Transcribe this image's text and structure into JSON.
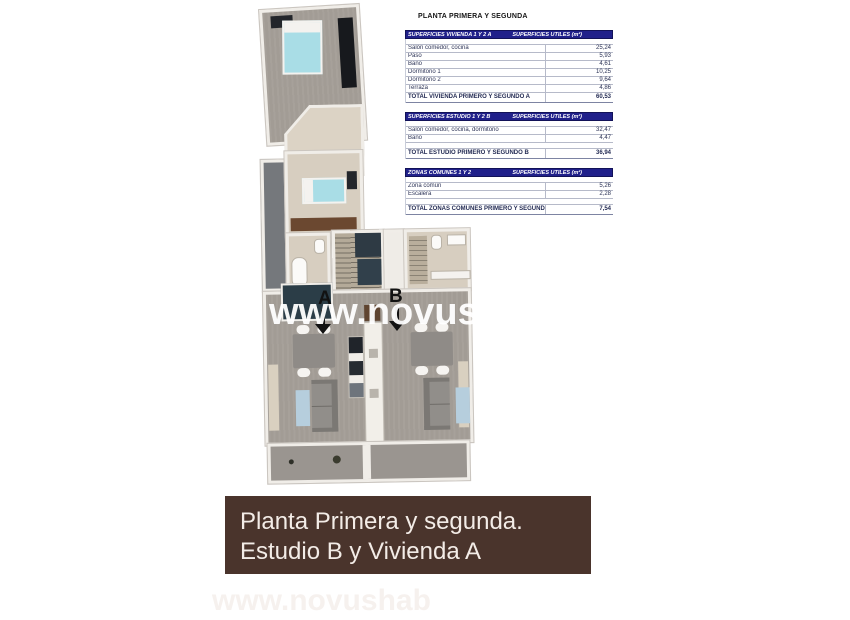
{
  "plan_title": "PLANTA PRIMERA Y SEGUNDA",
  "area_tables": [
    {
      "header_left": "SUPERFICIES VIVIENDA 1 Y 2 A",
      "header_right": "SUPERFICIES UTILES  (m²)",
      "rows": [
        {
          "label": "Salón comedor, cocina",
          "value": "25,24"
        },
        {
          "label": "Paso",
          "value": "5,93"
        },
        {
          "label": "Baño",
          "value": "4,61"
        },
        {
          "label": "Dormitorio 1",
          "value": "10,25"
        },
        {
          "label": "Dormitorio 2",
          "value": "9,64"
        },
        {
          "label": "Terraza",
          "value": "4,86"
        }
      ],
      "total_label": "TOTAL VIVIENDA PRIMERO Y SEGUNDO A",
      "total_value": "60,53"
    },
    {
      "header_left": "SUPERFICIES ESTUDIO 1 Y 2 B",
      "header_right": "SUPERFICIES UTILES  (m²)",
      "rows": [
        {
          "label": "Salón comedor, cocina, dormitorio",
          "value": "32,47"
        },
        {
          "label": "Baño",
          "value": "4,47"
        }
      ],
      "total_label": "TOTAL ESTUDIO PRIMERO Y SEGUNDO B",
      "total_value": "36,94"
    },
    {
      "header_left": "ZONAS COMUNES 1 Y 2",
      "header_right": "SUPERFICIES UTILES  (m²)",
      "rows": [
        {
          "label": "Zona común",
          "value": "5,26"
        },
        {
          "label": "Escalera",
          "value": "2,28"
        }
      ],
      "total_label": "TOTAL ZONAS COMUNES PRIMERO Y SEGUNDO",
      "total_value": "7,54"
    }
  ],
  "floor_plan": {
    "unit_a": "A",
    "unit_b": "B",
    "watermark": "www.novushab"
  },
  "caption": {
    "line1": "Planta Primera y segunda.",
    "line2": "Estudio B y Vivienda A"
  },
  "colors": {
    "table_header_bg": "#20208a",
    "caption_bg": "#4a342c",
    "bed": "#a9dde6",
    "floor_gray": "#a29c95",
    "floor_beige": "#d7cec0"
  }
}
